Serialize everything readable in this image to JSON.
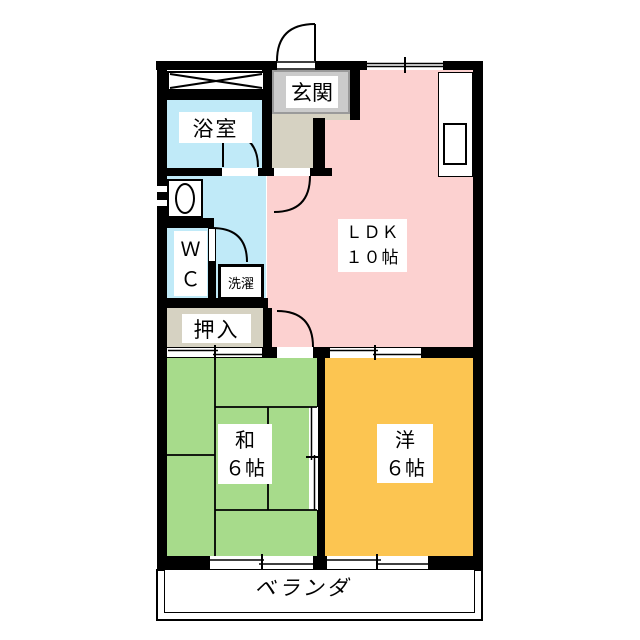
{
  "document": {
    "type": "apartment-floor-plan",
    "layout_type": "2LDK"
  },
  "labels": {
    "genkan": "玄関",
    "bathroom": "浴室",
    "wc_line1": "Ｗ",
    "wc_line2": "Ｃ",
    "laundry": "洗濯",
    "oshiire": "押入",
    "ldk_line1": "ＬＤＫ",
    "ldk_line2": "１０帖",
    "washitsu_line1": "和",
    "washitsu_line2": "６帖",
    "youshitsu_line1": "洋",
    "youshitsu_line2": "６帖",
    "veranda": "ベランダ"
  },
  "rooms": [
    {
      "name": "玄関",
      "type": "entrance"
    },
    {
      "name": "浴室",
      "type": "bathroom"
    },
    {
      "name": "WC",
      "type": "toilet"
    },
    {
      "name": "洗濯",
      "type": "laundry-space"
    },
    {
      "name": "押入",
      "type": "closet"
    },
    {
      "name": "ＬＤＫ",
      "size": "１０帖",
      "type": "living-dining-kitchen"
    },
    {
      "name": "和",
      "size": "６帖",
      "type": "japanese-room"
    },
    {
      "name": "洋",
      "size": "６帖",
      "type": "western-room"
    },
    {
      "name": "ベランダ",
      "type": "balcony"
    }
  ],
  "colors": {
    "wall": "#000000",
    "ldk_floor": "#fcd1d0",
    "wet_area_floor": "#c0eaf8",
    "tatami_floor": "#a7db8b",
    "western_floor": "#fcc551",
    "hall_floor": "#d6d2c2",
    "entrance_tile": "#cbcbcb",
    "entrance_tile_border": "#9a9a9a",
    "label_background": "#ffffff"
  },
  "fixtures": [
    "storage-cross-box",
    "kitchen-counter",
    "kitchen-sink",
    "washbasin",
    "laundry-box",
    "tatami-mats"
  ]
}
